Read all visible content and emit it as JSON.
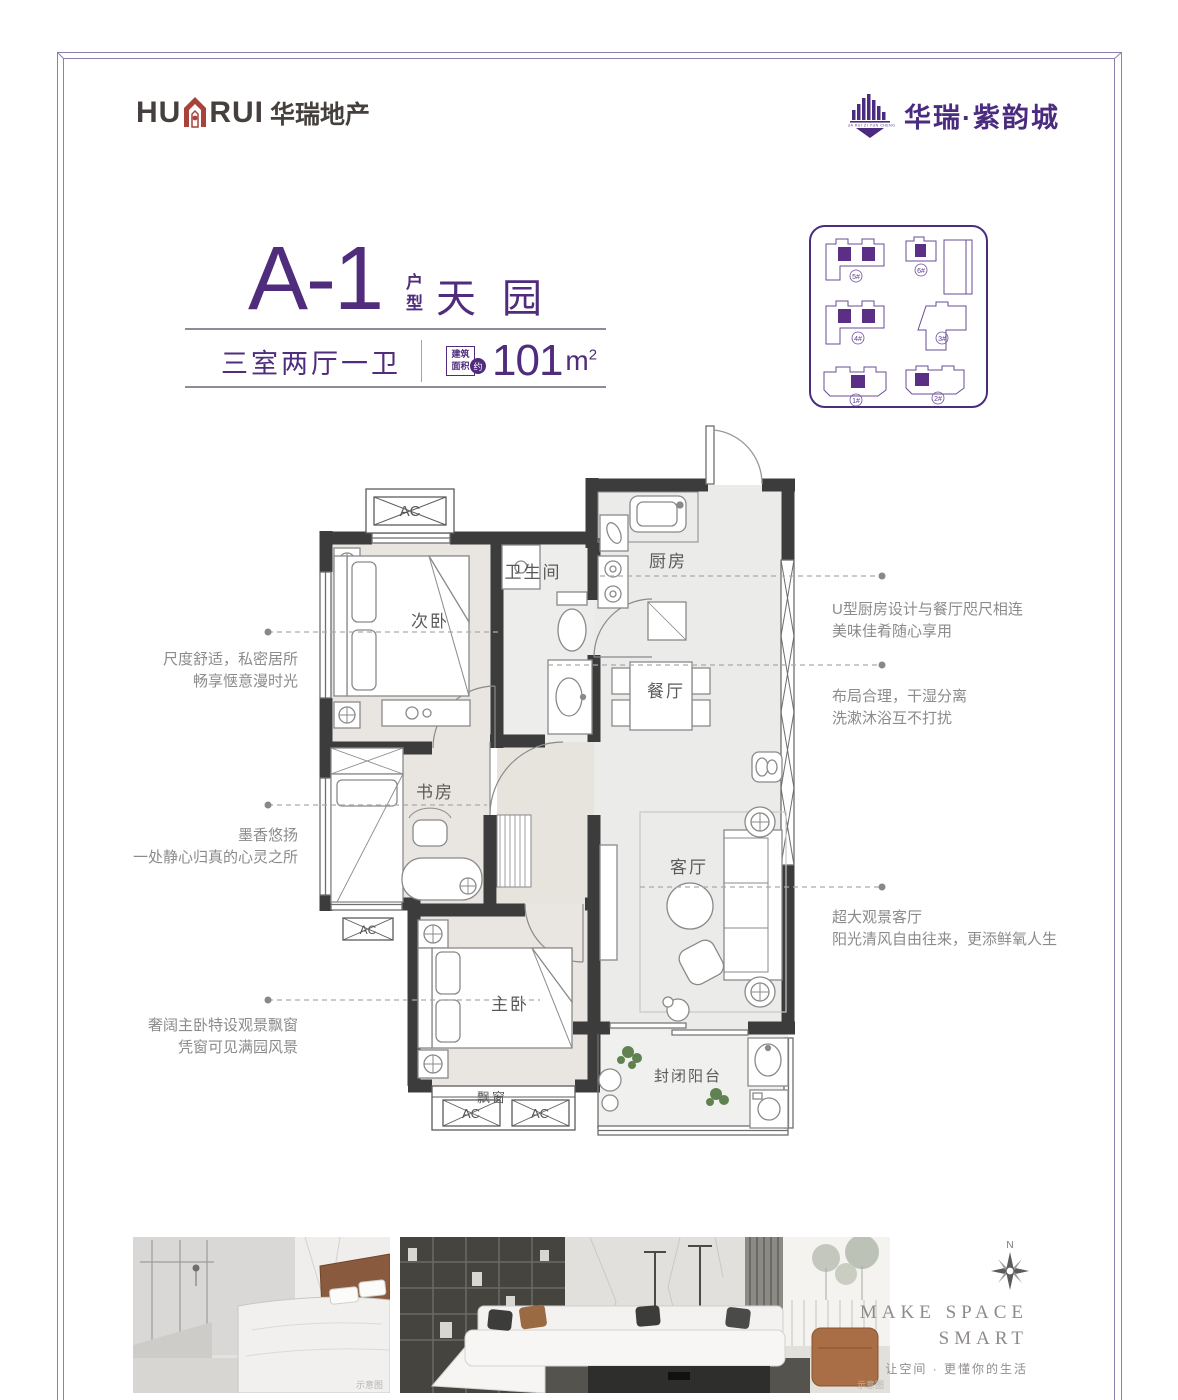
{
  "header": {
    "brand_left": {
      "en_prefix": "HU",
      "en_suffix": "RUI",
      "cn": "华瑞地产"
    },
    "brand_right": {
      "name": "华瑞·紫韵城",
      "tagline": "HUA RUI ZI YUN CHENG"
    }
  },
  "title": {
    "unit": "A-1",
    "unit_suffix_top": "户",
    "unit_suffix_bottom": "型",
    "name": "天园",
    "layout": "三室两厅一卫",
    "area_badge_top": "建筑",
    "area_badge_bottom": "面积",
    "area_approx": "约",
    "area_value": "101",
    "area_unit": "m",
    "area_exponent": "2"
  },
  "siteplan": {
    "building_labels": [
      "5#",
      "6#",
      "4#",
      "3#",
      "1#",
      "2#"
    ]
  },
  "floorplan": {
    "rooms": {
      "secondary_bedroom": "次卧",
      "bathroom": "卫生间",
      "kitchen": "厨房",
      "dining": "餐厅",
      "study": "书房",
      "living": "客厅",
      "master_bedroom": "主卧",
      "balcony": "封闭阳台"
    },
    "bay_window": "飘窗",
    "ac_label": "AC"
  },
  "annotations": {
    "left": [
      {
        "line1": "尺度舒适，私密居所",
        "line2": "畅享惬意漫时光"
      },
      {
        "line1": "墨香悠扬",
        "line2": "一处静心归真的心灵之所"
      },
      {
        "line1": "奢阔主卧特设观景飘窗",
        "line2": "凭窗可见满园风景"
      }
    ],
    "right": [
      {
        "line1": "U型厨房设计与餐厅咫尺相连",
        "line2": "美味佳肴随心享用"
      },
      {
        "line1": "布局合理，干湿分离",
        "line2": "洗漱沐浴互不打扰"
      },
      {
        "line1": "超大观景客厅",
        "line2": "阳光清风自由往来，更添鲜氧人生"
      }
    ]
  },
  "footer": {
    "compass_label": "N",
    "slogan_line1": "MAKE SPACE",
    "slogan_line2": "SMART",
    "slogan_cn": "让空间 · 更懂你的生活",
    "render_caption": "示意图"
  },
  "colors": {
    "brand_purple": "#4F2C7C",
    "brand_red": "#A8423A",
    "wall": "#3C3C3C"
  }
}
